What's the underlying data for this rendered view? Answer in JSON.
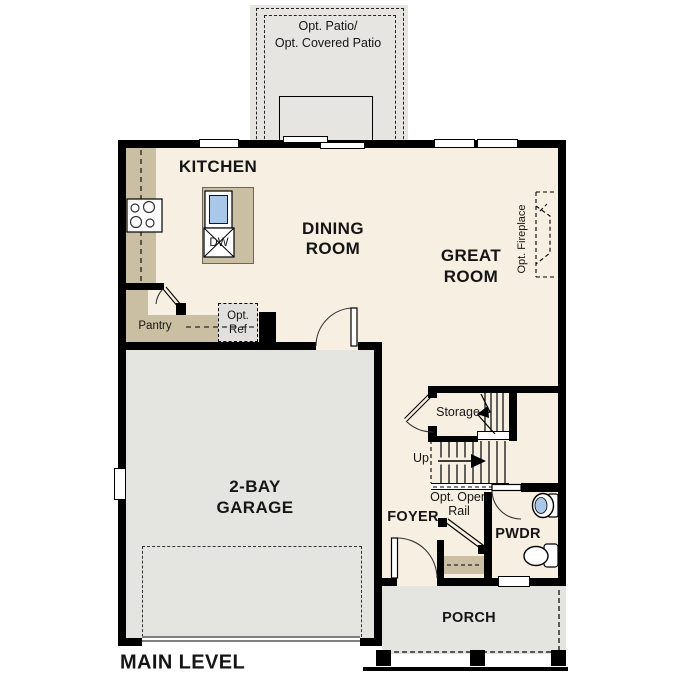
{
  "title": "MAIN LEVEL",
  "colors": {
    "floor": "#f7efe1",
    "garage_gray": "#e4e4e0",
    "patio_gray": "#e6e5e1",
    "counter_tan": "#cbbfa3",
    "fixture_blue": "#a9c7e9",
    "wall": "#000000",
    "text": "#151515"
  },
  "labels": {
    "patio_line1": "Opt. Patio/",
    "patio_line2": "Opt. Covered Patio",
    "kitchen": "KITCHEN",
    "dining_line1": "DINING",
    "dining_line2": "ROOM",
    "great_line1": "GREAT",
    "great_line2": "ROOM",
    "fireplace": "Opt. Fireplace",
    "pantry": "Pantry",
    "ref_line1": "Opt.",
    "ref_line2": "Ref",
    "dishwasher": "DW",
    "garage_line1": "2-BAY",
    "garage_line2": "GARAGE",
    "storage": "Storage",
    "up": "Up",
    "rail_line1": "Opt. Open",
    "rail_line2": "Rail",
    "foyer": "FOYER",
    "pwdr": "PWDR",
    "porch": "PORCH",
    "main_level": "MAIN LEVEL"
  }
}
